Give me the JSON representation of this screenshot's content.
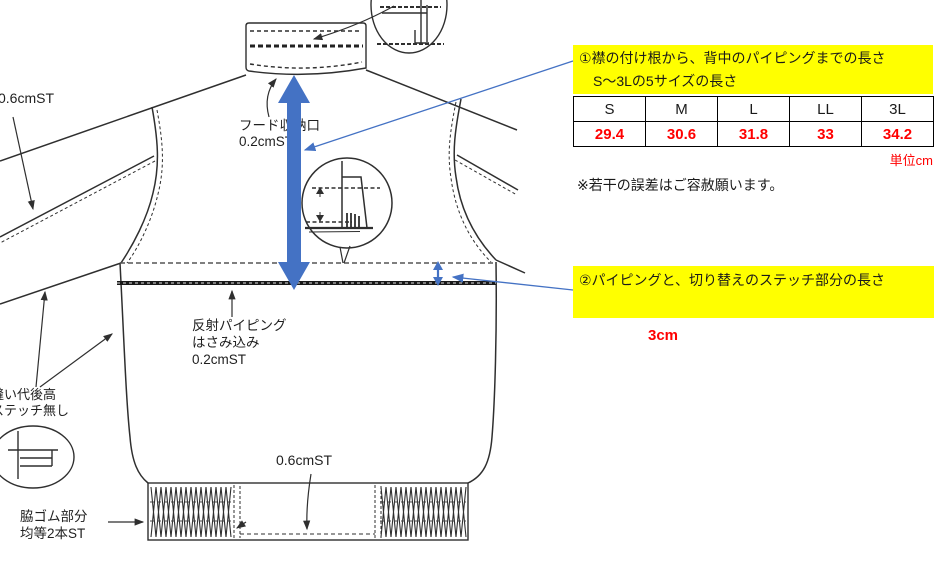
{
  "callout1": {
    "line1": "①襟の付け根から、背中のパイピングまでの長さ",
    "line2": "S〜3Lの5サイズの長さ"
  },
  "size_table": {
    "headers": [
      "S",
      "M",
      "L",
      "LL",
      "3L"
    ],
    "values": [
      "29.4",
      "30.6",
      "31.8",
      "33",
      "34.2"
    ],
    "unit": "単位cm"
  },
  "note": "※若干の誤差はご容赦願います。",
  "callout2": {
    "line1": "②パイピングと、切り替えのステッチ部分の長さ",
    "value": "3cm"
  },
  "garment_labels": {
    "sleeve_stitch": "0.6cmST",
    "hood_line1": "フード収納口",
    "hood_line2": "0.2cmST",
    "detail_gap": "3.0",
    "piping_line1": "反射パイピング",
    "piping_line2": "はさみ込み",
    "piping_line3": "0.2cmST",
    "seam_line1": "縫い代後高",
    "seam_line2": "ステッチ無し",
    "elastic_line1": "脇ゴム部分",
    "elastic_line2": "均等2本ST",
    "hem_stitch": "0.6cmST",
    "hem_gap": "0.6"
  },
  "colors": {
    "arrow_blue": "#4472c4",
    "highlight_yellow": "#ffff00",
    "accent_red": "#ff0000",
    "line_black": "#2f2f2f"
  }
}
